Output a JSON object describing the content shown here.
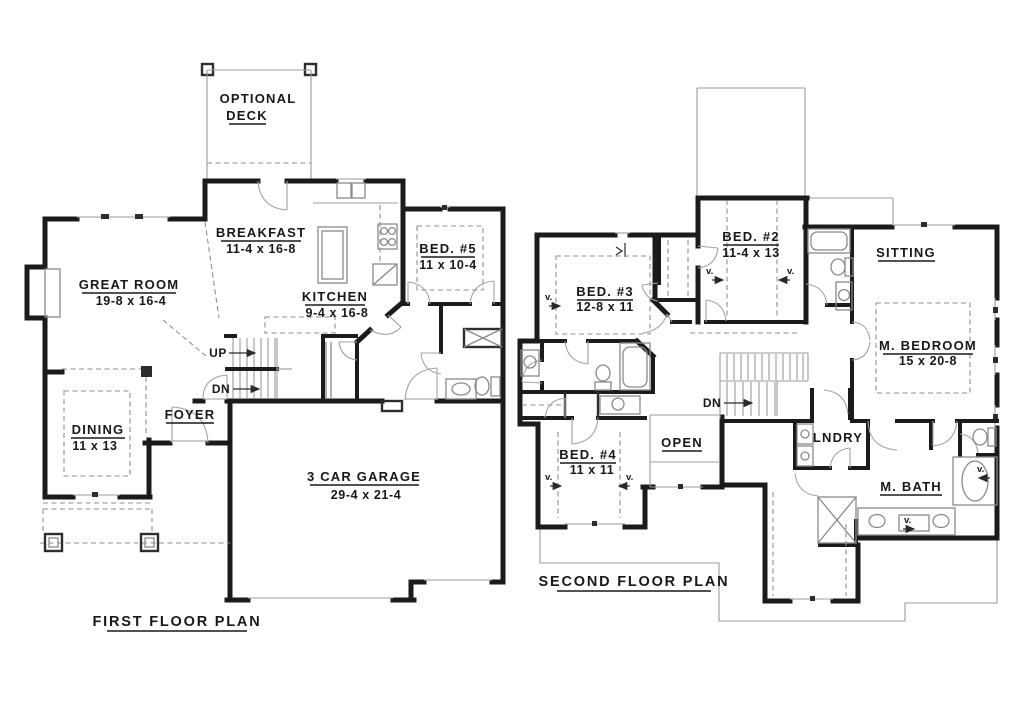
{
  "page": {
    "background": "#ffffff",
    "ink": "#181818"
  },
  "first_floor": {
    "title": "FIRST FLOOR PLAN",
    "deck": {
      "line1": "OPTIONAL",
      "line2": "DECK"
    },
    "rooms": {
      "breakfast": {
        "name": "BREAKFAST",
        "dims": "11-4 x 16-8"
      },
      "great_room": {
        "name": "GREAT ROOM",
        "dims": "19-8 x 16-4"
      },
      "kitchen": {
        "name": "KITCHEN",
        "dims": "9-4 x 16-8"
      },
      "bed5": {
        "name": "BED. #5",
        "dims": "11 x 10-4"
      },
      "dining": {
        "name": "DINING",
        "dims": "11 x 13"
      },
      "foyer": {
        "name": "FOYER"
      },
      "garage": {
        "name": "3 CAR GARAGE",
        "dims": "29-4 x 21-4"
      }
    },
    "annotations": {
      "up": "UP",
      "down": "DN"
    }
  },
  "second_floor": {
    "title": "SECOND FLOOR PLAN",
    "rooms": {
      "bed2": {
        "name": "BED. #2",
        "dims": "11-4 x 13"
      },
      "bed3": {
        "name": "BED. #3",
        "dims": "12-8 x 11"
      },
      "bed4": {
        "name": "BED. #4",
        "dims": "11 x 11"
      },
      "sitting": {
        "name": "SITTING"
      },
      "master_bedroom": {
        "name": "M. BEDROOM",
        "dims": "15 x 20-8"
      },
      "master_bath": {
        "name": "M. BATH"
      },
      "laundry": {
        "name": "LNDRY"
      },
      "open_below": {
        "name": "OPEN"
      }
    },
    "annotations": {
      "down": "DN",
      "vault": "v."
    }
  }
}
